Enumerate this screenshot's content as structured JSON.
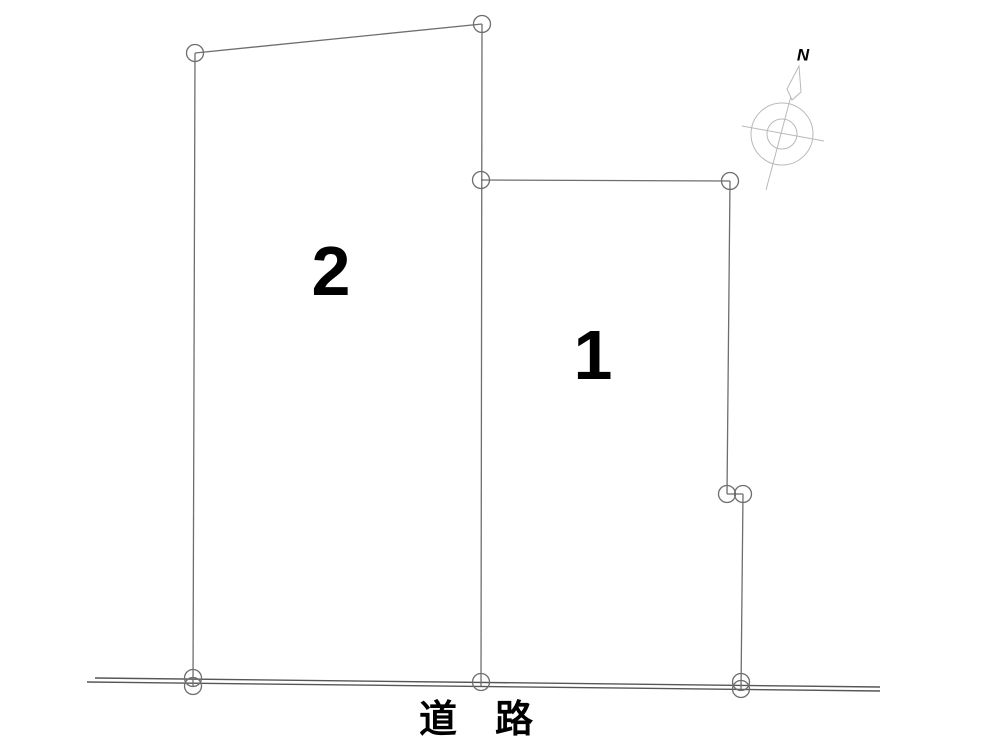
{
  "page": {
    "background": "#ffffff",
    "type": "land-lot-layout-plan"
  },
  "diagram": {
    "colors": {
      "lot_line": "#6e6e6e",
      "road_line": "#565656",
      "compass": "#b9b9b9",
      "text": "#000000"
    },
    "lots": [
      {
        "id": "lot-1",
        "label": "1",
        "label_x": 593,
        "label_y": 355
      },
      {
        "id": "lot-2",
        "label": "2",
        "label_x": 331,
        "label_y": 271
      }
    ],
    "road": {
      "label": "道　路",
      "label_x": 476,
      "label_y": 720
    },
    "compass": {
      "label": "N",
      "label_x": 803,
      "label_y": 55
    },
    "geometry": {
      "point_radius": 8.5,
      "segments": [
        {
          "name": "road-line-upper",
          "x1": 95,
          "y1": 678,
          "x2": 880,
          "y2": 687,
          "kind": "road"
        },
        {
          "name": "road-line-lower",
          "x1": 87,
          "y1": 682,
          "x2": 880,
          "y2": 691,
          "kind": "road"
        },
        {
          "name": "lot2-left-edge",
          "x1": 195,
          "y1": 53,
          "x2": 193,
          "y2": 687,
          "kind": "lot"
        },
        {
          "name": "lot2-top-edge",
          "x1": 195,
          "y1": 53,
          "x2": 482,
          "y2": 24,
          "kind": "lot"
        },
        {
          "name": "lot2-lot1-shared-edge",
          "x1": 482,
          "y1": 24,
          "x2": 481,
          "y2": 686,
          "kind": "lot"
        },
        {
          "name": "lot1-top-edge",
          "x1": 481,
          "y1": 180,
          "x2": 730,
          "y2": 181,
          "kind": "lot"
        },
        {
          "name": "lot1-right-edge-upper",
          "x1": 730,
          "y1": 181,
          "x2": 727,
          "y2": 494,
          "kind": "lot"
        },
        {
          "name": "lot1-right-edge-jog",
          "x1": 727,
          "y1": 494,
          "x2": 743,
          "y2": 494,
          "kind": "lot"
        },
        {
          "name": "lot1-right-edge-lower",
          "x1": 743,
          "y1": 494,
          "x2": 741,
          "y2": 690,
          "kind": "lot"
        }
      ],
      "survey_points": [
        {
          "cx": 195,
          "cy": 53
        },
        {
          "cx": 482,
          "cy": 24
        },
        {
          "cx": 481,
          "cy": 180
        },
        {
          "cx": 730,
          "cy": 181
        },
        {
          "cx": 727,
          "cy": 494
        },
        {
          "cx": 743,
          "cy": 494
        },
        {
          "cx": 193,
          "cy": 678
        },
        {
          "cx": 193,
          "cy": 686
        },
        {
          "cx": 481,
          "cy": 682
        },
        {
          "cx": 741,
          "cy": 682
        },
        {
          "cx": 741,
          "cy": 689
        }
      ],
      "compass": {
        "outer_circle": {
          "cx": 782,
          "cy": 134,
          "r": 31
        },
        "inner_circle": {
          "cx": 782,
          "cy": 134,
          "r": 15
        },
        "axis_line": {
          "x1": 799,
          "y1": 66,
          "x2": 766,
          "y2": 190
        },
        "cross_line": {
          "x1": 742,
          "y1": 126,
          "x2": 824,
          "y2": 141
        },
        "needle": [
          [
            799,
            66
          ],
          [
            787,
            89
          ],
          [
            792,
            100
          ],
          [
            801,
            92
          ]
        ]
      }
    }
  }
}
